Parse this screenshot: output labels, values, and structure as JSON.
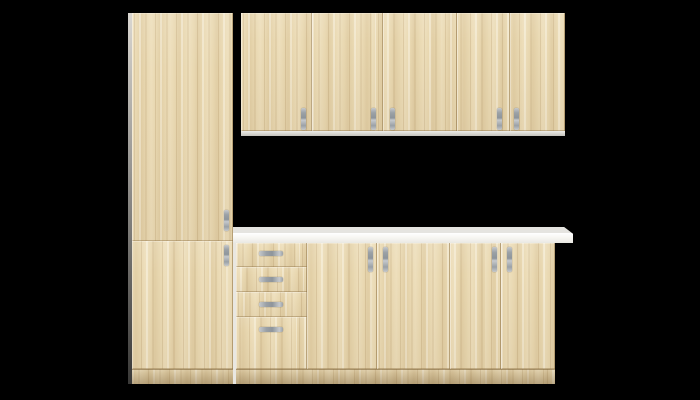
{
  "scene": {
    "type": "product-render",
    "subject": "kitchen-cabinet-set",
    "style": "flat-front light oak (sonoma) doors with white carcass and white worktop",
    "background_color": "#000000"
  },
  "palette": {
    "background": "#000000",
    "wood": "#e9d8b1",
    "wood_dark": "#cfb789",
    "wood_light": "#f3e8cb",
    "seam": "#97794c",
    "carcass": "#f0efea",
    "carcass_shadow": "#dcdad3",
    "countertop_face": "#f7f6f2",
    "countertop_top": "#e5e4e0",
    "handle": "#9ba1a6",
    "handle_light": "#c6c9cc"
  },
  "inventory": {
    "tall_cabinet": {
      "label": "tall cabinet",
      "doors": 2,
      "handle_type": "vertical-bar"
    },
    "wall_cabinet_run": {
      "label": "wall cabinets",
      "doors": 5,
      "handle_type": "vertical-bar"
    },
    "drawer_unit": {
      "label": "base drawer unit",
      "drawers": 4,
      "handle_type": "horizontal-bar"
    },
    "base_cabinet_run": {
      "label": "base cabinets",
      "cabinets": 2,
      "doors_per_cabinet": 2,
      "handle_type": "vertical-bar"
    },
    "countertop": {
      "label": "worktop",
      "color_name": "white"
    }
  }
}
